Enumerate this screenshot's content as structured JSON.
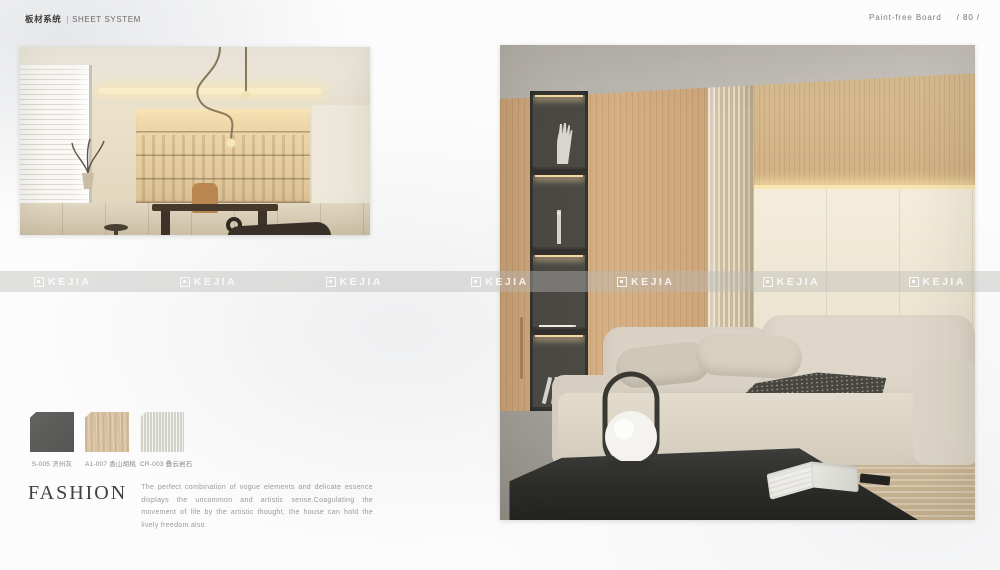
{
  "header": {
    "left_zh": "板材系统",
    "divider": "|",
    "left_en": "SHEET SYSTEM",
    "right_label": "Paint-free  Board",
    "page_number": "/ 80 /"
  },
  "watermark": {
    "brand": "KEJIA",
    "icon": "kejia-mark-icon",
    "band_color": "#d9d9d7"
  },
  "swatches": {
    "items": [
      {
        "code": "S-005",
        "name": "济州灰",
        "color": "#5a5a58"
      },
      {
        "code": "A1-007",
        "name": "香山胡桃",
        "color": "#d9c2a2"
      },
      {
        "code": "CR-003",
        "name": "叠云岩石",
        "color": "#dcdcd4"
      }
    ]
  },
  "fashion": {
    "title": "FASHION",
    "body": "The perfect combination of vogue elements and delicate essence displays the uncommon and artistic sense.Coagulating the movement of life by the artistic thought, the house can hold the lively freedom also."
  }
}
